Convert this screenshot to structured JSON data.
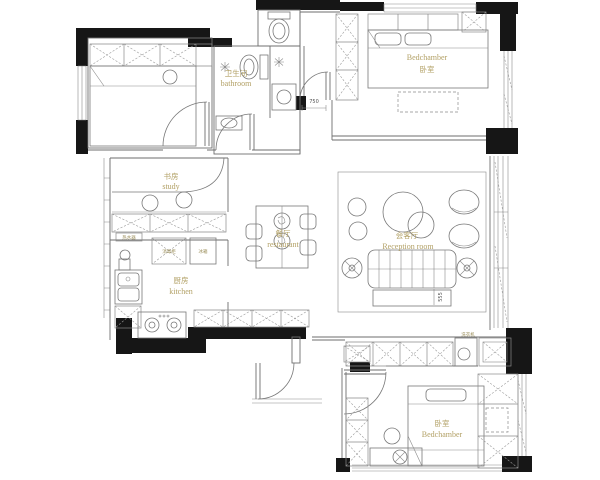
{
  "title": "apartment floor plan",
  "colors": {
    "wall": "#161616",
    "line": "#6e6e6e",
    "label": "#b2a065",
    "dim": "#555555"
  },
  "rooms": {
    "bedroom_top": {
      "en": "Bedchamber",
      "zh": "卧室"
    },
    "bathroom": {
      "zh": "卫生间",
      "en": "bathroom"
    },
    "study": {
      "zh": "书房",
      "en": "study"
    },
    "kitchen": {
      "zh": "厨房",
      "en": "kitchen"
    },
    "dining": {
      "zh": "餐厅",
      "en": "restaurant"
    },
    "reception": {
      "zh": "会客厅",
      "en": "Reception room"
    },
    "bedroom_bottom": {
      "zh": "卧室",
      "en": "Bedchamber"
    }
  },
  "appliances": {
    "fridge": "冰箱",
    "sterilizer": "消毒柜",
    "water_heater": "热水器",
    "washer": "洗衣机"
  },
  "dimensions": {
    "corridor_door": "750",
    "tv_cabinet": "555"
  }
}
